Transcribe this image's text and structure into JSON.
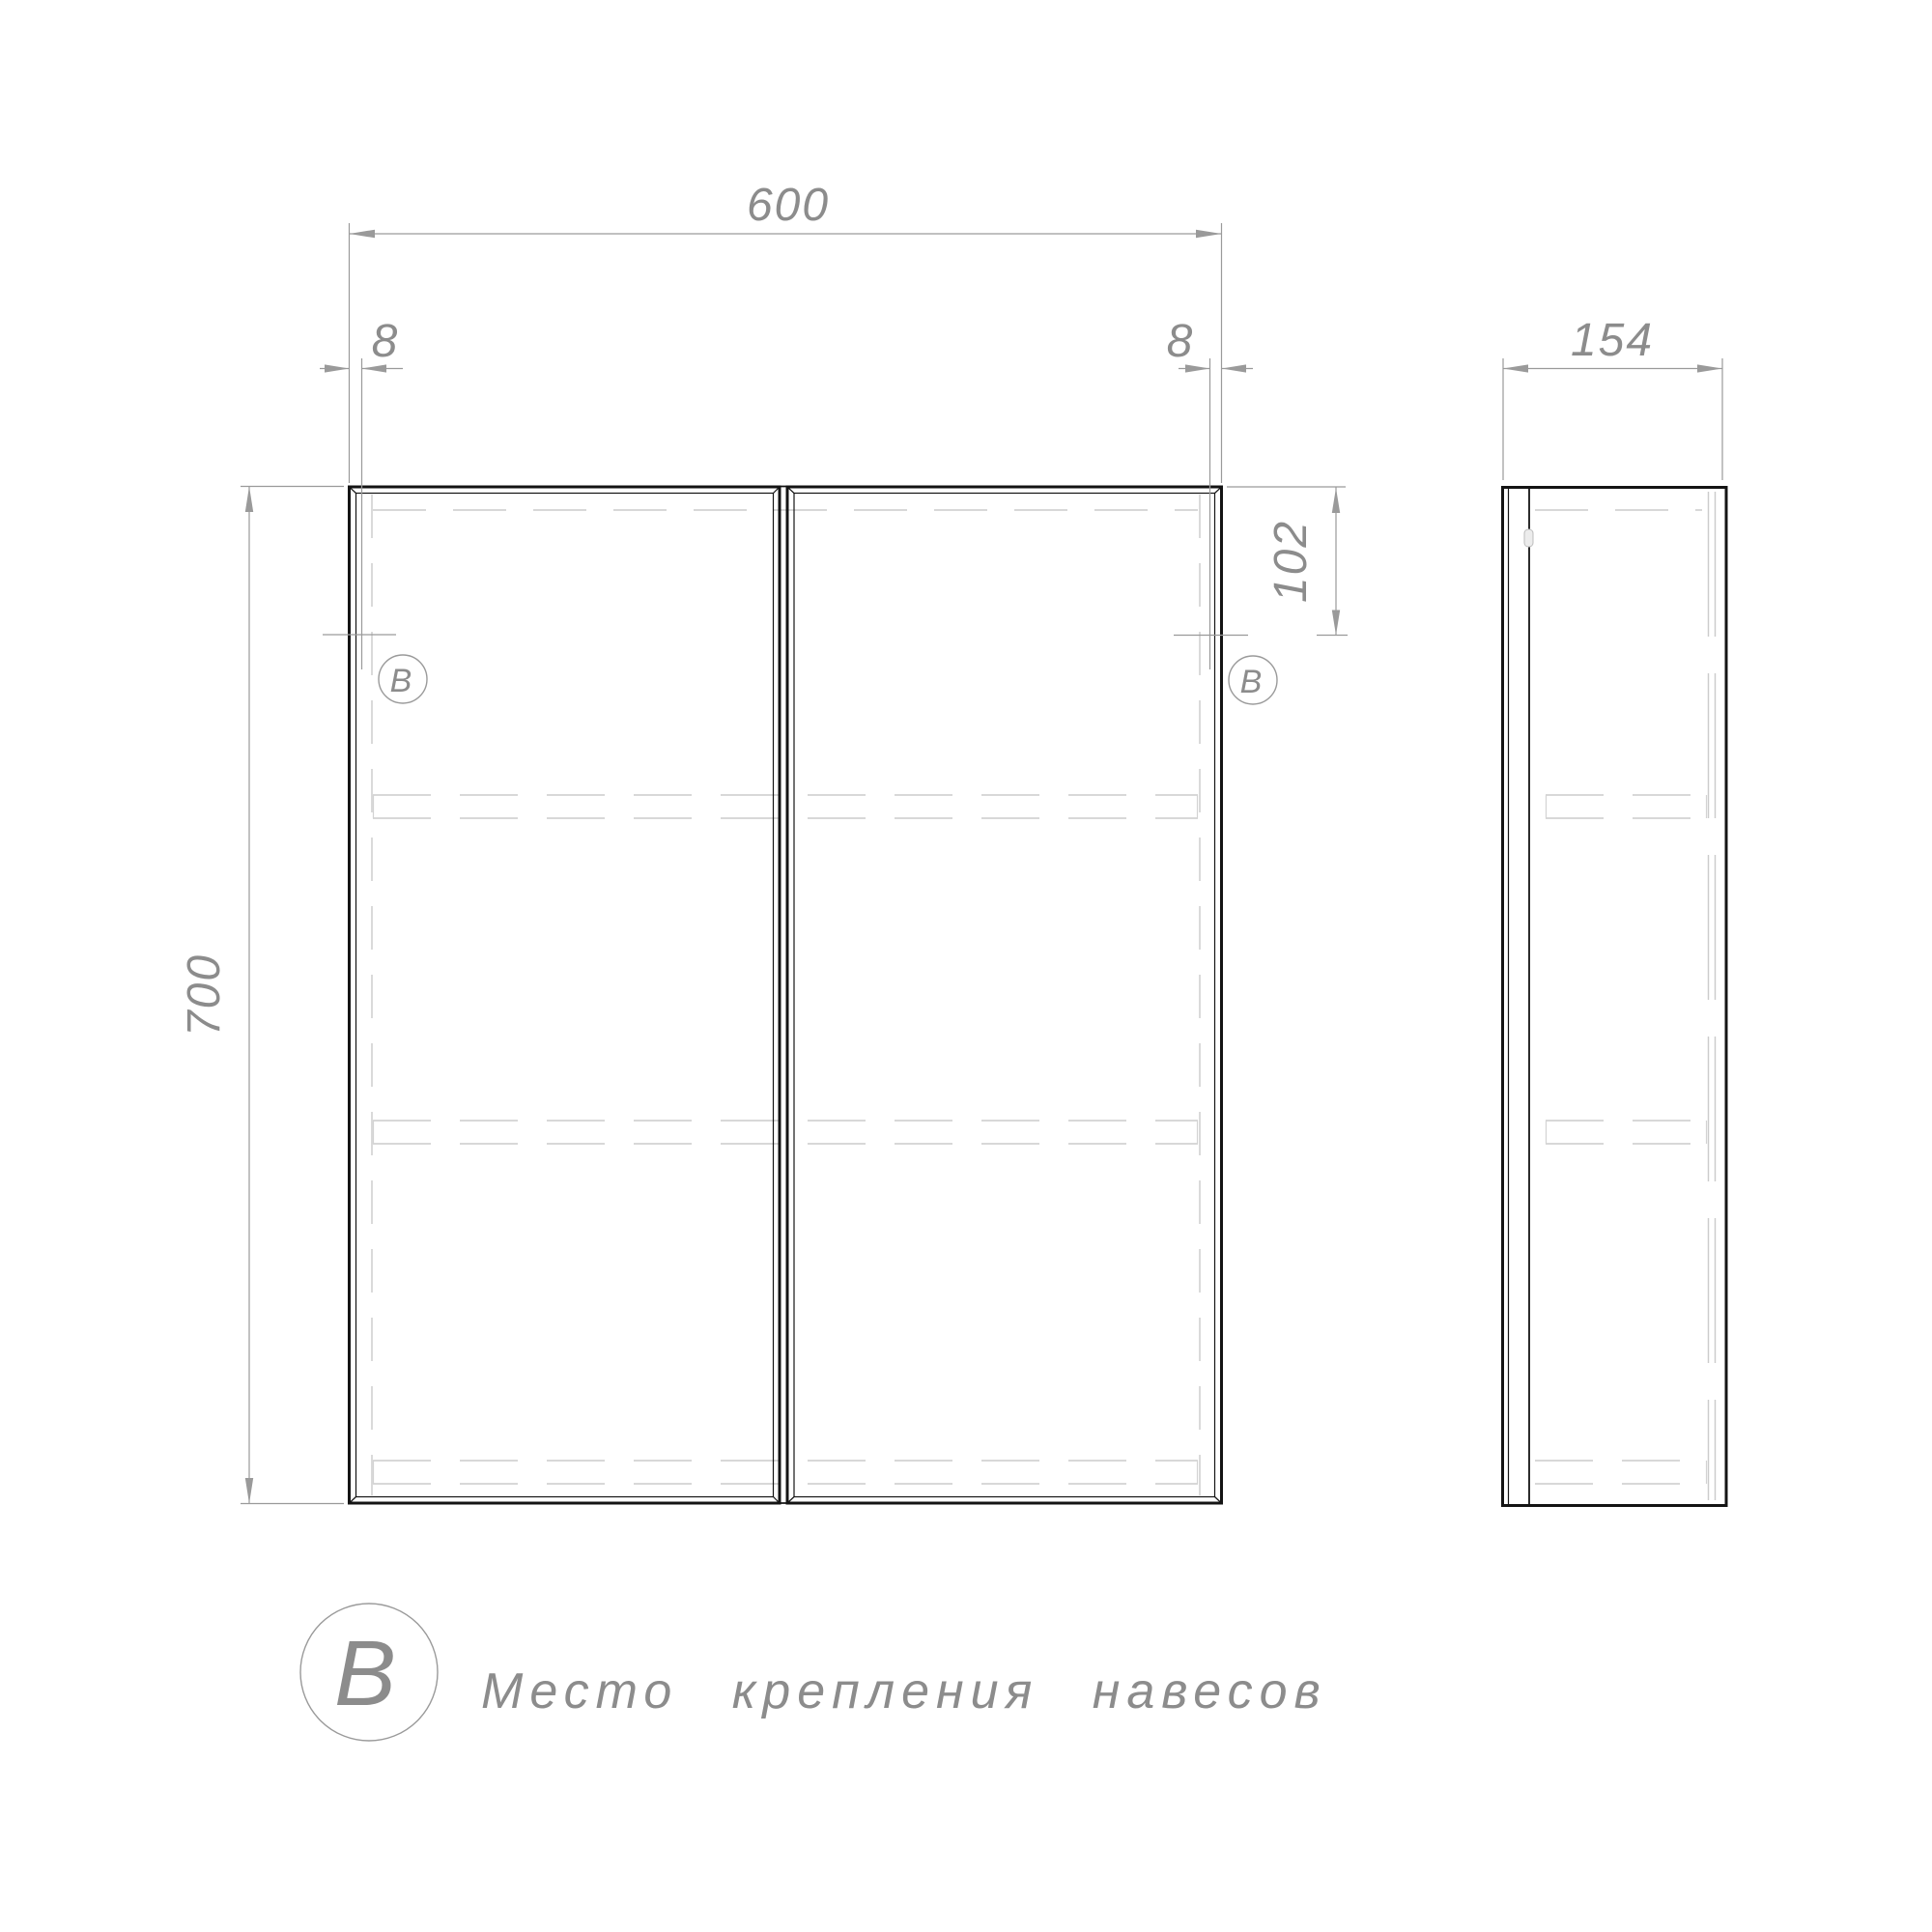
{
  "page": {
    "background": "#ffffff"
  },
  "colors": {
    "outline": "#141414",
    "dimension_lines": "#9a9a9a",
    "hidden_lines": "#cbcbcb",
    "label_text": "#8c8c8c"
  },
  "front_view": {
    "dim_width": "600",
    "dim_height": "700",
    "dim_offset_left": "8",
    "dim_offset_right": "8",
    "dim_mount_from_top": "102",
    "marker_left": "В",
    "marker_right": "В"
  },
  "side_view": {
    "dim_depth": "154"
  },
  "legend": {
    "symbol": "В",
    "text": "Место крепления навесов"
  }
}
